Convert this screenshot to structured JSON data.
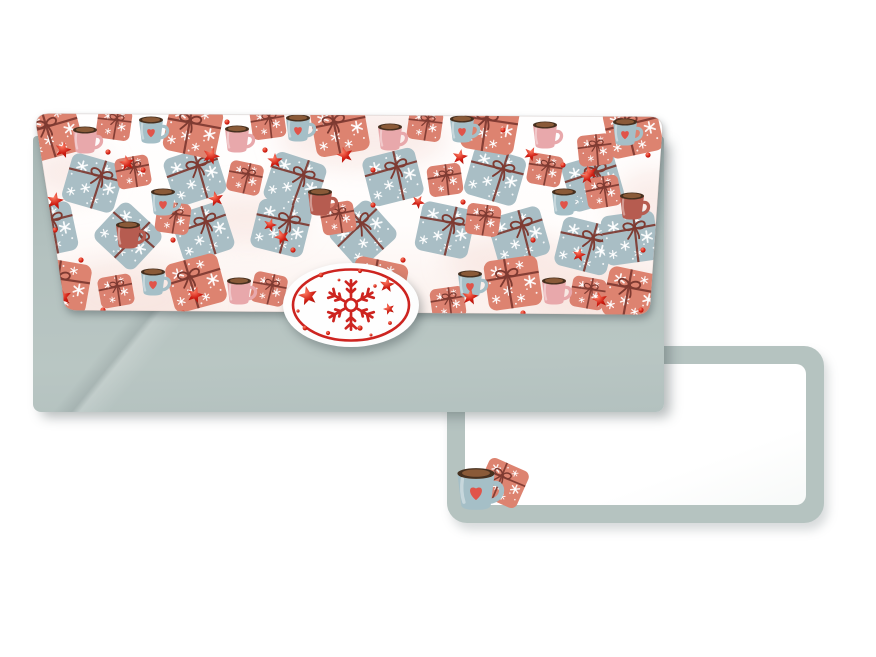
{
  "scene": {
    "width": 876,
    "height": 657,
    "background": "#ffffff"
  },
  "colors": {
    "pageBg": "#ffffff",
    "envelope": "#b3c1bf",
    "envelopeDark": "#a7b6b4",
    "envelopeLight": "#b9c6c3",
    "cardBorder": "#b5c3c0",
    "cardFace": "#ffffff",
    "flapBase": "#fffdfc",
    "flapTint": "#fbf0ec",
    "wash": "#f5dcd5",
    "coral": "#dd8370",
    "coral2": "#db8170",
    "blue": "#a9bec5",
    "ribbon": "#7e3a31",
    "mugblue": "#a5bfc7",
    "mugpink": "#e8a8ab",
    "mugdark": "#b65c50",
    "mugint": "#47301f",
    "cocoa": "#8a5a38",
    "heart": "#e0544a",
    "star1": "#ff8066",
    "star2": "#cf1d12",
    "star3": "#a51309",
    "seal": "#cd2420",
    "sealEdge": "#ececee"
  },
  "envelope": {
    "flap_pattern_items": [
      [
        "giftBlue",
        60,
        73,
        16
      ],
      [
        "giftBlue",
        162,
        66,
        -18
      ],
      [
        "giftBlue",
        262,
        72,
        18
      ],
      [
        "giftBlue",
        360,
        67,
        -14
      ],
      [
        "giftBlue",
        462,
        66,
        16
      ],
      [
        "giftBlue",
        560,
        72,
        -16
      ],
      [
        "giftBlue",
        15,
        120,
        -12
      ],
      [
        "giftBlue",
        95,
        126,
        43
      ],
      [
        "giftBlue",
        170,
        122,
        -18
      ],
      [
        "giftBlue",
        248,
        118,
        14
      ],
      [
        "giftBlue",
        330,
        124,
        -42
      ],
      [
        "giftBlue",
        412,
        120,
        12
      ],
      [
        "giftBlue",
        486,
        126,
        -16
      ],
      [
        "giftBlue",
        552,
        136,
        14
      ],
      [
        "giftBlue",
        597,
        128,
        -8
      ],
      [
        "giftCoral",
        20,
        22,
        -15
      ],
      [
        "giftCoral",
        160,
        20,
        12
      ],
      [
        "giftCoral",
        307,
        19,
        -10
      ],
      [
        "giftCoral",
        457,
        17,
        10
      ],
      [
        "giftCoral",
        600,
        20,
        -12
      ],
      [
        "giftCoral",
        29,
        176,
        10
      ],
      [
        "giftCoral",
        163,
        173,
        -15
      ],
      [
        "giftCoral",
        345,
        175,
        12
      ],
      [
        "giftCoral",
        480,
        173,
        -8
      ],
      [
        "giftCoral",
        599,
        185,
        12
      ],
      [
        "giftS",
        81,
        14,
        8
      ],
      [
        "giftS",
        235,
        13,
        -8
      ],
      [
        "giftS",
        392,
        15,
        8
      ],
      [
        "giftS",
        562,
        40,
        -6
      ],
      [
        "giftS",
        570,
        82,
        -10
      ],
      [
        "giftS",
        100,
        62,
        -10
      ],
      [
        "giftS",
        212,
        68,
        12
      ],
      [
        "giftS",
        412,
        70,
        -8
      ],
      [
        "giftS",
        512,
        60,
        10
      ],
      [
        "giftS",
        140,
        108,
        8
      ],
      [
        "giftS",
        305,
        108,
        -10
      ],
      [
        "giftS",
        450,
        110,
        8
      ],
      [
        "giftS",
        83,
        181,
        -10
      ],
      [
        "giftS",
        236,
        179,
        12
      ],
      [
        "giftS",
        415,
        193,
        -8
      ],
      [
        "giftS",
        555,
        183,
        10
      ],
      [
        "mugBlue",
        118,
        20
      ],
      [
        "mugBlue",
        265,
        18
      ],
      [
        "mugBlue",
        429,
        19
      ],
      [
        "mugBlue",
        592,
        22
      ],
      [
        "mugBlue",
        130,
        92
      ],
      [
        "mugBlue",
        531,
        92
      ],
      [
        "mugBlue",
        120,
        172
      ],
      [
        "mugBlue",
        437,
        174
      ],
      [
        "mugPink",
        52,
        30
      ],
      [
        "mugPink",
        204,
        29
      ],
      [
        "mugPink",
        357,
        27
      ],
      [
        "mugPink",
        512,
        25
      ],
      [
        "mugPink",
        206,
        181
      ],
      [
        "mugPink",
        521,
        181
      ],
      [
        "mugDark",
        95,
        125
      ],
      [
        "mugDark",
        287,
        92
      ],
      [
        "mugDark",
        599,
        96
      ],
      [
        "star",
        30,
        40,
        15,
        0.85
      ],
      [
        "star",
        94,
        53,
        -10,
        0.8
      ],
      [
        "star",
        178,
        46,
        20,
        0.9
      ],
      [
        "star",
        242,
        51,
        0,
        0.8
      ],
      [
        "star",
        312,
        45,
        -15,
        0.85
      ],
      [
        "star",
        427,
        47,
        10,
        0.8
      ],
      [
        "star",
        498,
        44,
        25,
        0.75
      ],
      [
        "star",
        557,
        63,
        -20,
        0.8
      ],
      [
        "star",
        22,
        91,
        10,
        0.9
      ],
      [
        "star",
        183,
        89,
        -12,
        0.8
      ],
      [
        "star",
        237,
        115,
        18,
        0.7
      ],
      [
        "star",
        554,
        67,
        0,
        0.75
      ],
      [
        "star",
        249,
        127,
        -20,
        0.8
      ],
      [
        "star",
        546,
        145,
        12,
        0.7
      ],
      [
        "star",
        385,
        92,
        30,
        0.7
      ],
      [
        "star",
        30,
        187,
        -10,
        0.9
      ],
      [
        "star",
        162,
        185,
        15,
        0.85
      ],
      [
        "star",
        297,
        190,
        -18,
        0.8
      ],
      [
        "star",
        437,
        187,
        8,
        0.85
      ],
      [
        "star",
        567,
        190,
        -12,
        0.8
      ],
      [
        "dot",
        75,
        42
      ],
      [
        "dot",
        194,
        12
      ],
      [
        "dot",
        232,
        40
      ],
      [
        "dot",
        110,
        60
      ],
      [
        "dot",
        340,
        60
      ],
      [
        "dot",
        470,
        20
      ],
      [
        "dot",
        530,
        55
      ],
      [
        "dot",
        615,
        45
      ],
      [
        "dot",
        22,
        120
      ],
      [
        "dot",
        340,
        95
      ],
      [
        "dot",
        430,
        92
      ],
      [
        "dot",
        140,
        130
      ],
      [
        "dot",
        260,
        140
      ],
      [
        "dot",
        500,
        130
      ],
      [
        "dot",
        610,
        140
      ],
      [
        "dot",
        48,
        150
      ],
      [
        "dot",
        370,
        150
      ],
      [
        "dot",
        70,
        200
      ],
      [
        "dot",
        150,
        203
      ],
      [
        "dot",
        260,
        200
      ],
      [
        "dot",
        330,
        203
      ],
      [
        "dot",
        490,
        203
      ],
      [
        "dot",
        608,
        200
      ]
    ]
  },
  "seal": {
    "stars": [
      [
        -43,
        -9,
        -12,
        1.0
      ],
      [
        36,
        -20,
        8,
        0.78
      ],
      [
        38,
        4,
        -18,
        0.6
      ]
    ],
    "dots": [
      [
        -30,
        -30,
        2.4
      ],
      [
        9,
        -34,
        2.1
      ],
      [
        -46,
        23,
        2.4
      ],
      [
        -23,
        28,
        2.1
      ],
      [
        9,
        23,
        2.6
      ],
      [
        24,
        -19,
        1.7
      ],
      [
        39,
        18,
        1.9
      ],
      [
        -53,
        6,
        1.6
      ],
      [
        -12,
        -25,
        1.4
      ],
      [
        20,
        30,
        1.5
      ]
    ]
  },
  "card_motif": {
    "gift": [
      48,
      30,
      24,
      0.8
    ],
    "mug": [
      21,
      36,
      0,
      1.55
    ]
  }
}
